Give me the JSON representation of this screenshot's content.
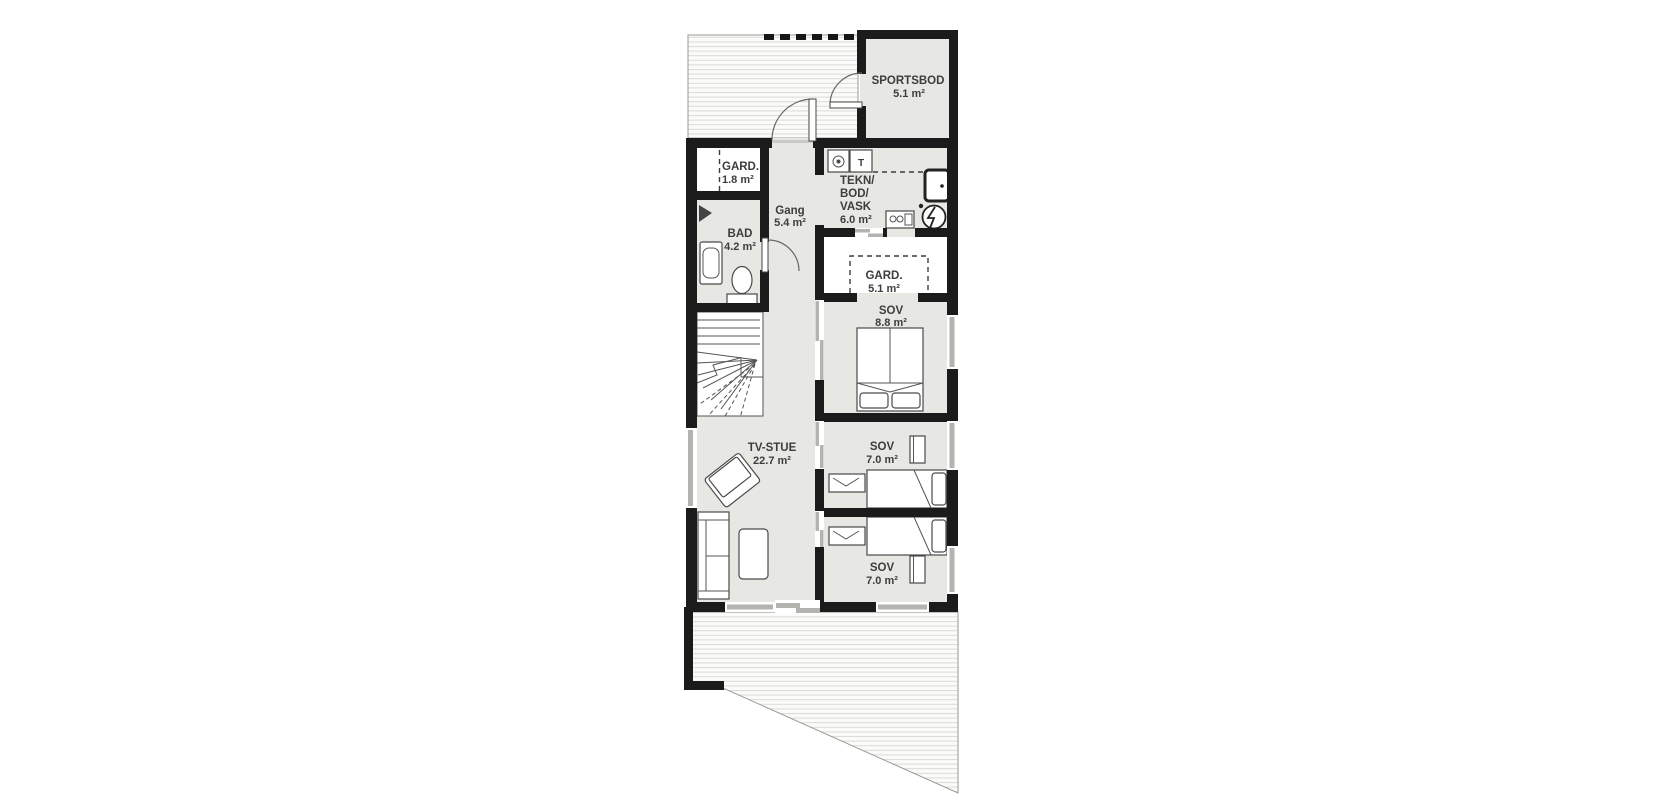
{
  "floorplan": {
    "rooms": {
      "sportsbod": {
        "name": "SPORTSBOD",
        "area": "5.1 m²"
      },
      "gard_entry": {
        "name": "GARD.",
        "area": "1.8 m²"
      },
      "gang": {
        "name": "Gang",
        "area": "5.4 m²"
      },
      "tekn": {
        "name_line1": "TEKN/",
        "name_line2": "BOD/",
        "name_line3": "VASK",
        "area": "6.0 m²"
      },
      "bad": {
        "name": "BAD",
        "area": "4.2 m²"
      },
      "gard_master": {
        "name": "GARD.",
        "area": "5.1 m²"
      },
      "sov_master": {
        "name": "SOV",
        "area": "8.8 m²"
      },
      "tv_stue": {
        "name": "TV-STUE",
        "area": "22.7 m²"
      },
      "sov_mid": {
        "name": "SOV",
        "area": "7.0 m²"
      },
      "sov_south": {
        "name": "SOV",
        "area": "7.0 m²"
      }
    },
    "appliances": {
      "dryer_label": "T"
    },
    "colors": {
      "wall": "#1b1b1b",
      "floor_gray": "#e7e7e3",
      "floor_white": "#ffffff",
      "window_gray": "#b3b3af",
      "deck_line": "#dadad6",
      "label_text": "#3d3d3d"
    }
  }
}
